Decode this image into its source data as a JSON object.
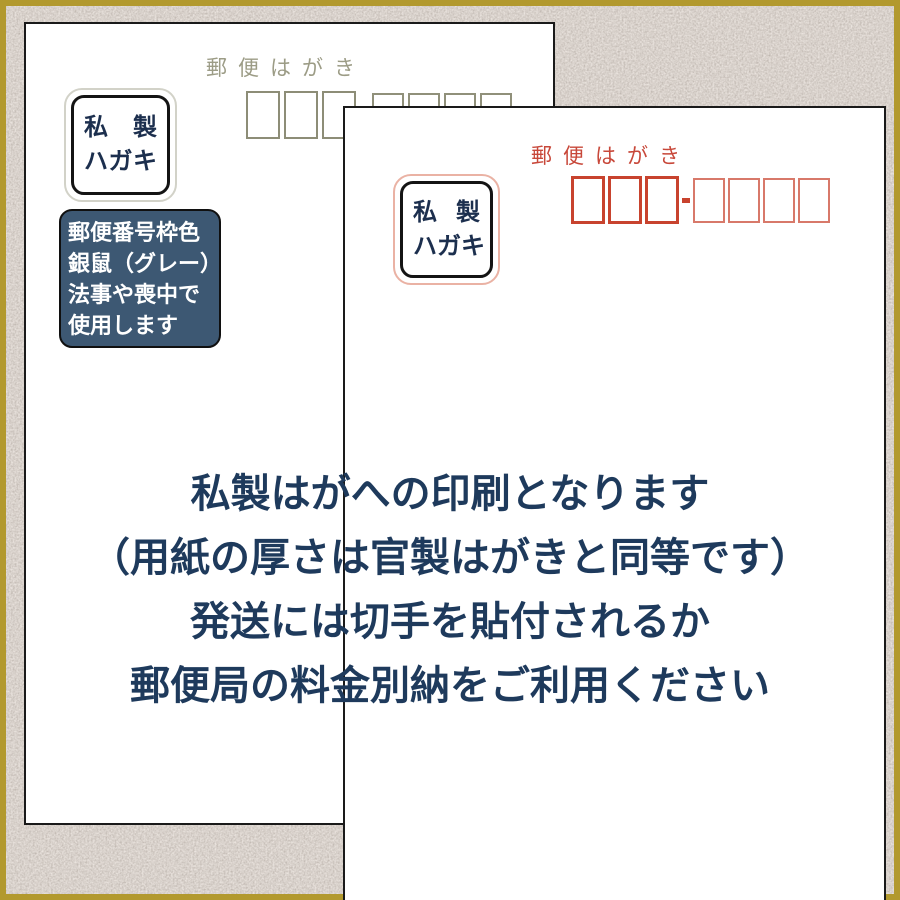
{
  "colors": {
    "gold_frame": "#b2992e",
    "texture_base": "#a89c93",
    "card_border": "#1a1a1a",
    "gray_ink": "#9c9c86",
    "gray_box": "#8d8d77",
    "red_ink": "#c8483a",
    "red_box_bold": "#c8432e",
    "red_box_light": "#d8796a",
    "navy_label_text": "#1c2f4e",
    "note_box_bg": "#3d5873",
    "caption_text": "#1e3a5c"
  },
  "back_card": {
    "header": "郵便はがき",
    "label": {
      "line1": "私製",
      "line2": "ハガキ"
    },
    "postal_code_boxes": {
      "large": 3,
      "small": 4
    },
    "note_box": {
      "lines": [
        "郵便番号枠色",
        "銀鼠（グレー）",
        "法事や喪中で",
        "使用します"
      ]
    }
  },
  "front_card": {
    "header": "郵便はがき",
    "label": {
      "line1": "私製",
      "line2": "ハガキ"
    },
    "postal_code_boxes": {
      "large": 3,
      "small": 4
    }
  },
  "caption": {
    "lines": [
      "私製はがへの印刷となります",
      "（用紙の厚さは官製はがきと同等です）",
      "発送には切手を貼付されるか",
      "郵便局の料金別納をご利用ください"
    ]
  }
}
